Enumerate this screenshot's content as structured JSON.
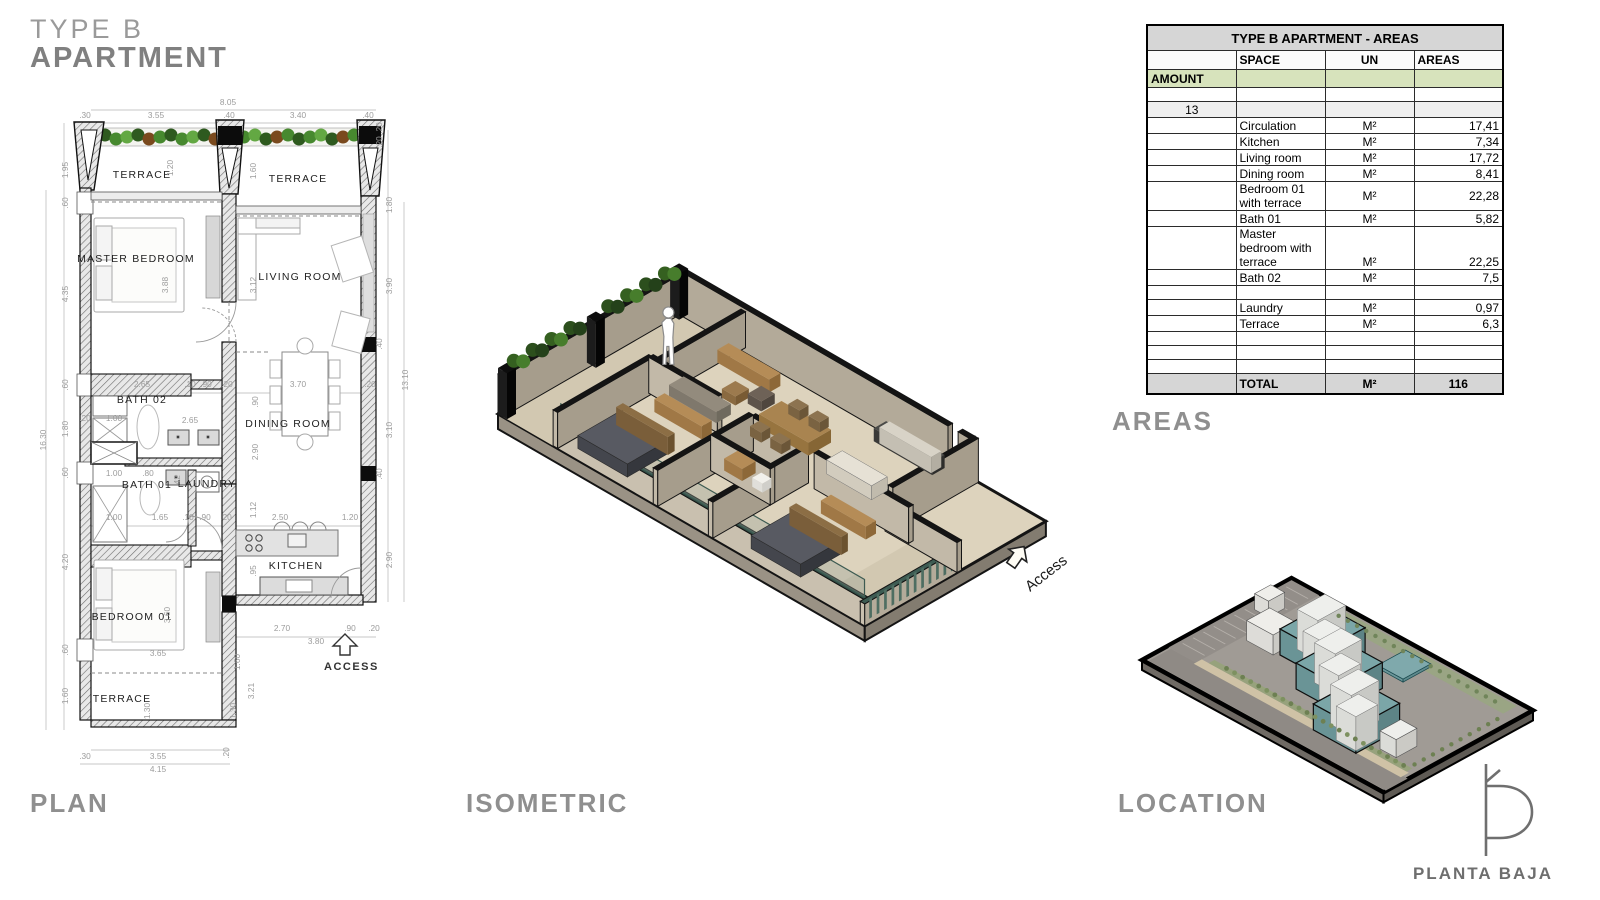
{
  "title": {
    "line1": "TYPE B",
    "line2": "APARTMENT"
  },
  "sections": {
    "plan": "PLAN",
    "isometric": "ISOMETRIC",
    "areas": "AREAS",
    "location": "LOCATION"
  },
  "logo": {
    "text": "PLANTA BAJA"
  },
  "areas_table": {
    "title": "TYPE B APARTMENT - AREAS",
    "headers": {
      "amount": "AMOUNT",
      "space": "SPACE",
      "un": "UN",
      "areas": "AREAS"
    },
    "amount_value": "13",
    "rows": [
      {
        "space": "Circulation",
        "un": "M²",
        "areas": "17,41"
      },
      {
        "space": "Kitchen",
        "un": "M²",
        "areas": "7,34"
      },
      {
        "space": "Living room",
        "un": "M²",
        "areas": "17,72"
      },
      {
        "space": "Dining room",
        "un": "M²",
        "areas": "8,41"
      },
      {
        "space": "Bedroom 01 with terrace",
        "un": "M²",
        "areas": "22,28"
      },
      {
        "space": "Bath 01",
        "un": "M²",
        "areas": "5,82"
      },
      {
        "space": "Master bedroom with terrace",
        "un": "M²",
        "areas": "22,25",
        "tall": true
      },
      {
        "space": "Bath 02",
        "un": "M²",
        "areas": "7,5"
      },
      {
        "space": "",
        "un": "",
        "areas": "",
        "blank": true
      },
      {
        "space": "Laundry",
        "un": "M²",
        "areas": "0,97"
      },
      {
        "space": "Terrace",
        "un": "M²",
        "areas": "6,3"
      },
      {
        "space": "",
        "un": "",
        "areas": "",
        "blank": true
      },
      {
        "space": "",
        "un": "",
        "areas": "",
        "blank": true
      },
      {
        "space": "",
        "un": "",
        "areas": "",
        "blank": true
      }
    ],
    "total": {
      "label": "TOTAL",
      "un": "M²",
      "areas": "116"
    }
  },
  "plan": {
    "access_label": "ACCESS",
    "rooms": [
      {
        "t": "TERRACE",
        "x": 112,
        "y": 88
      },
      {
        "t": "TERRACE",
        "x": 268,
        "y": 92
      },
      {
        "t": "MASTER BEDROOM",
        "x": 106,
        "y": 172
      },
      {
        "t": "LIVING ROOM",
        "x": 270,
        "y": 190
      },
      {
        "t": "BATH 02",
        "x": 112,
        "y": 313
      },
      {
        "t": "DINING ROOM",
        "x": 258,
        "y": 337
      },
      {
        "t": "BATH 01",
        "x": 117,
        "y": 398
      },
      {
        "t": "LAUNDRY",
        "x": 177,
        "y": 397
      },
      {
        "t": "KITCHEN",
        "x": 266,
        "y": 479
      },
      {
        "t": "BEDROOM 01",
        "x": 102,
        "y": 530
      },
      {
        "t": "TERRACE",
        "x": 92,
        "y": 612
      }
    ],
    "dims": [
      {
        "t": "8.05",
        "x": 198,
        "y": 15
      },
      {
        "t": ".30",
        "x": 55,
        "y": 28
      },
      {
        "t": "3.55",
        "x": 126,
        "y": 28
      },
      {
        "t": ".40",
        "x": 199,
        "y": 28
      },
      {
        "t": "3.40",
        "x": 268,
        "y": 28
      },
      {
        "t": ".40",
        "x": 338,
        "y": 28
      },
      {
        "t": "1.95",
        "x": 38,
        "y": 80,
        "r": 1
      },
      {
        "t": ".60",
        "x": 38,
        "y": 113,
        "r": 1
      },
      {
        "t": "4.35",
        "x": 38,
        "y": 204,
        "r": 1
      },
      {
        "t": ".60",
        "x": 38,
        "y": 295,
        "r": 1
      },
      {
        "t": "1.80",
        "x": 38,
        "y": 339,
        "r": 1
      },
      {
        "t": ".60",
        "x": 38,
        "y": 383,
        "r": 1
      },
      {
        "t": "4.20",
        "x": 38,
        "y": 472,
        "r": 1
      },
      {
        "t": ".60",
        "x": 38,
        "y": 560,
        "r": 1
      },
      {
        "t": "1.60",
        "x": 38,
        "y": 606,
        "r": 1
      },
      {
        "t": "16.30",
        "x": 16,
        "y": 350,
        "r": 1
      },
      {
        "t": ".20",
        "x": 352,
        "y": 38,
        "r": 1
      },
      {
        "t": ".20",
        "x": 352,
        "y": 52,
        "r": 1
      },
      {
        "t": "1.80",
        "x": 362,
        "y": 115,
        "r": 1
      },
      {
        "t": "3.90",
        "x": 362,
        "y": 196,
        "r": 1
      },
      {
        "t": ".40",
        "x": 352,
        "y": 254,
        "r": 1
      },
      {
        "t": "13.10",
        "x": 378,
        "y": 290,
        "r": 1
      },
      {
        "t": "3.10",
        "x": 362,
        "y": 340,
        "r": 1
      },
      {
        "t": ".40",
        "x": 352,
        "y": 384,
        "r": 1
      },
      {
        "t": "2.90",
        "x": 362,
        "y": 470,
        "r": 1
      },
      {
        "t": "1.20",
        "x": 143,
        "y": 78,
        "r": 1
      },
      {
        "t": "1.60",
        "x": 226,
        "y": 81,
        "r": 1
      },
      {
        "t": "3.88",
        "x": 138,
        "y": 195,
        "r": 1
      },
      {
        "t": "3.12",
        "x": 226,
        "y": 195,
        "r": 1
      },
      {
        "t": "2.65",
        "x": 112,
        "y": 297
      },
      {
        "t": ".10",
        "x": 160,
        "y": 297
      },
      {
        "t": ".90",
        "x": 176,
        "y": 297
      },
      {
        "t": ".20",
        "x": 197,
        "y": 297
      },
      {
        "t": "3.70",
        "x": 268,
        "y": 297
      },
      {
        "t": ".20",
        "x": 340,
        "y": 297
      },
      {
        "t": ".90",
        "x": 228,
        "y": 312,
        "r": 1
      },
      {
        "t": "2.90",
        "x": 228,
        "y": 362,
        "r": 1
      },
      {
        "t": ".20",
        "x": 55,
        "y": 331
      },
      {
        "t": "1.00",
        "x": 84,
        "y": 331
      },
      {
        "t": "2.65",
        "x": 160,
        "y": 333
      },
      {
        "t": "1.00",
        "x": 84,
        "y": 386
      },
      {
        "t": ".80",
        "x": 118,
        "y": 386
      },
      {
        "t": ".42",
        "x": 150,
        "y": 391,
        "r": 1
      },
      {
        "t": "1.00",
        "x": 84,
        "y": 430
      },
      {
        "t": "1.65",
        "x": 130,
        "y": 430
      },
      {
        "t": ".10",
        "x": 158,
        "y": 430
      },
      {
        "t": ".90",
        "x": 175,
        "y": 430
      },
      {
        "t": ".20",
        "x": 196,
        "y": 430
      },
      {
        "t": "1.12",
        "x": 226,
        "y": 420,
        "r": 1
      },
      {
        "t": "2.50",
        "x": 250,
        "y": 430
      },
      {
        "t": "1.20",
        "x": 320,
        "y": 430
      },
      {
        "t": ".95",
        "x": 226,
        "y": 481,
        "r": 1
      },
      {
        "t": "2.70",
        "x": 252,
        "y": 541
      },
      {
        "t": ".90",
        "x": 320,
        "y": 541
      },
      {
        "t": ".20",
        "x": 344,
        "y": 541
      },
      {
        "t": "3.80",
        "x": 286,
        "y": 554
      },
      {
        "t": "3.60",
        "x": 140,
        "y": 525,
        "r": 1
      },
      {
        "t": "3.65",
        "x": 128,
        "y": 566
      },
      {
        "t": "1.60",
        "x": 210,
        "y": 572,
        "r": 1
      },
      {
        "t": "3.21",
        "x": 224,
        "y": 601,
        "r": 1
      },
      {
        "t": "1.30",
        "x": 120,
        "y": 621,
        "r": 1
      },
      {
        "t": "1.30",
        "x": 206,
        "y": 621,
        "r": 1
      },
      {
        "t": ".30",
        "x": 55,
        "y": 669
      },
      {
        "t": "3.55",
        "x": 128,
        "y": 669
      },
      {
        "t": ".20",
        "x": 199,
        "y": 663,
        "r": 1
      },
      {
        "t": "4.15",
        "x": 128,
        "y": 682
      }
    ]
  },
  "isometric": {
    "access_label": "Access"
  },
  "colors": {
    "accent_green_row": "#d7e3bc",
    "table_gray": "#d6d6d6",
    "heading_gray": "#8f8f8f",
    "plant_green": "#3c6428",
    "wall_taupe": "#b5ac9b",
    "floor_beige": "#ddd3bd",
    "wood": "#b28a52",
    "teal_building": "#7ba6a8",
    "black_cap": "#141414"
  }
}
